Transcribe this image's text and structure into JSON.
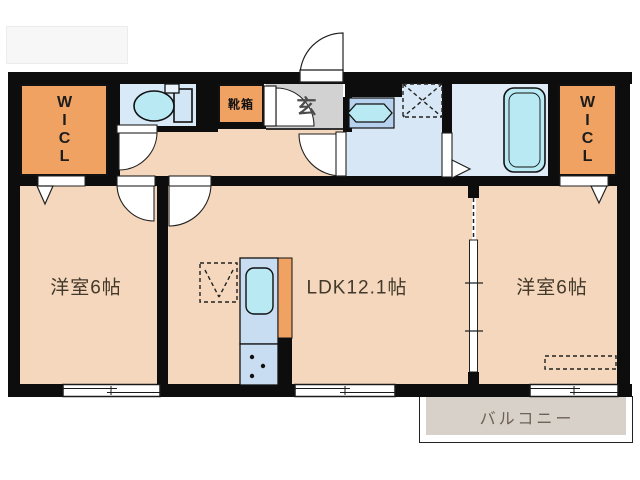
{
  "floor_plan": {
    "rooms": {
      "wicl_left": {
        "label": "WICL"
      },
      "toilet": {
        "label": ""
      },
      "shoe_box": {
        "label": "靴箱"
      },
      "entrance": {
        "label": "玄"
      },
      "washroom": {
        "label": ""
      },
      "bathroom": {
        "label": ""
      },
      "wicl_right": {
        "label": "WICL"
      },
      "bedroom_left": {
        "label": "洋室6帖"
      },
      "ldk": {
        "label": "LDK12.1帖"
      },
      "bedroom_right": {
        "label": "洋室6帖"
      },
      "balcony": {
        "label": "バルコニー"
      }
    },
    "icons": [
      "toilet-icon",
      "washbasin-icon",
      "bathtub-icon",
      "kitchen-sink-icon",
      "stove-burners-icon",
      "washing-machine-area-icon",
      "refrigerator-area-icon",
      "door-arc",
      "folding-door-triangle",
      "sliding-window"
    ],
    "colors": {
      "wall": "#0d0d0d",
      "floor_peach": "#f4d7bc",
      "closet_orange": "#f0a263",
      "toilet_room_blue": "#d8eaf8",
      "washroom_blue": "#d7e7f5",
      "bathroom_blue": "#dfecf8",
      "fixture_cyan": "#b9eaf4",
      "counter_blue": "#b7d2ee",
      "entrance_gray": "#d2d2d2",
      "balcony_gray": "#d8d1c9"
    }
  }
}
